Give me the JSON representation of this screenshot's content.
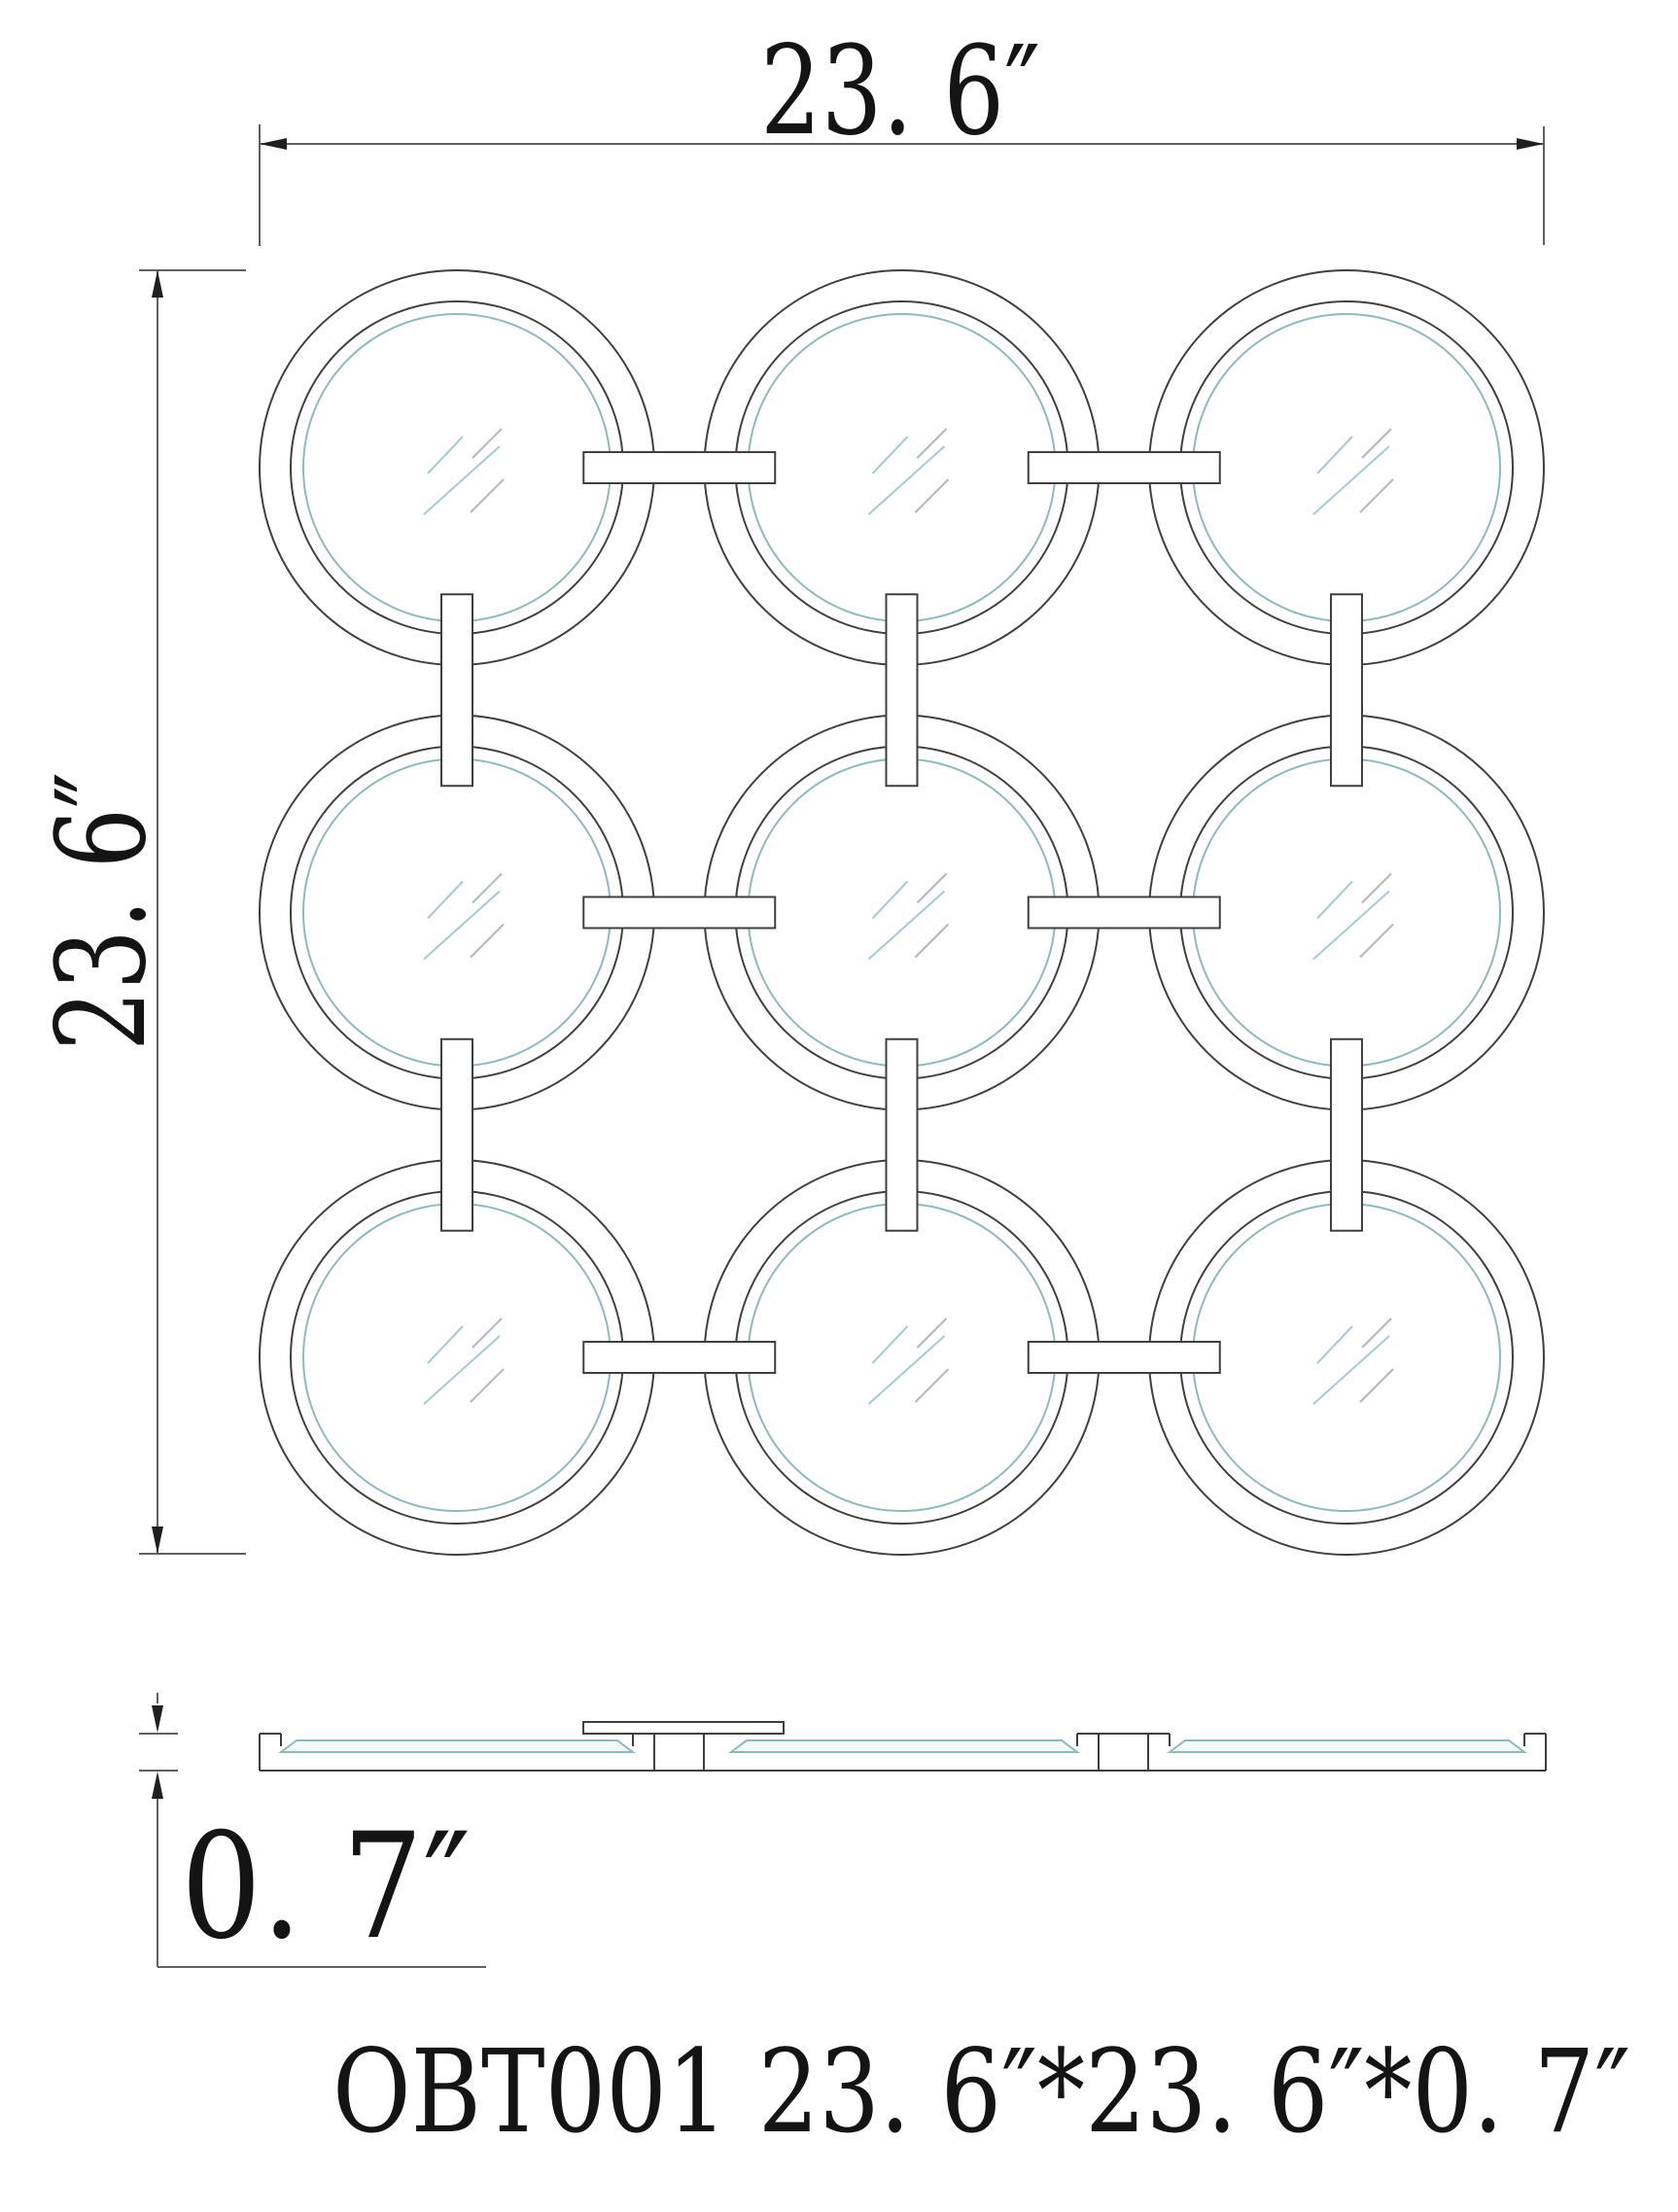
{
  "labels": {
    "width": "23. 6″",
    "height": "23. 6″",
    "depth": "0. 7″",
    "product": "OBT001 23. 6″*23. 6″*0. 7″"
  },
  "colors": {
    "line": "#3f3f3f",
    "teal": "#8fb9ba",
    "glass_fill": "#f2f9f9",
    "dim_line": "#606060",
    "arrow": "#1f1f1f",
    "text": "#141414",
    "hatch_blue": "#a5cbd1",
    "hatch_gray": "#b2b7bc"
  },
  "diagram": {
    "type": "technical-drawing",
    "product_code": "OBT001",
    "front": {
      "rows": 3,
      "cols": 3,
      "centers_x": [
        470,
        927.5,
        1385
      ],
      "centers_y": [
        481,
        938.5,
        1396
      ],
      "r_outer": 203,
      "r_ring": 171,
      "r_glass": 158,
      "link_length": 197,
      "link_thickness": 32,
      "hatch": [
        [
          -30,
          6,
          6,
          -32
        ],
        [
          16,
          -10,
          46,
          -40
        ],
        [
          -34,
          48,
          44,
          -22
        ],
        [
          14,
          46,
          48,
          12
        ]
      ]
    }
  }
}
